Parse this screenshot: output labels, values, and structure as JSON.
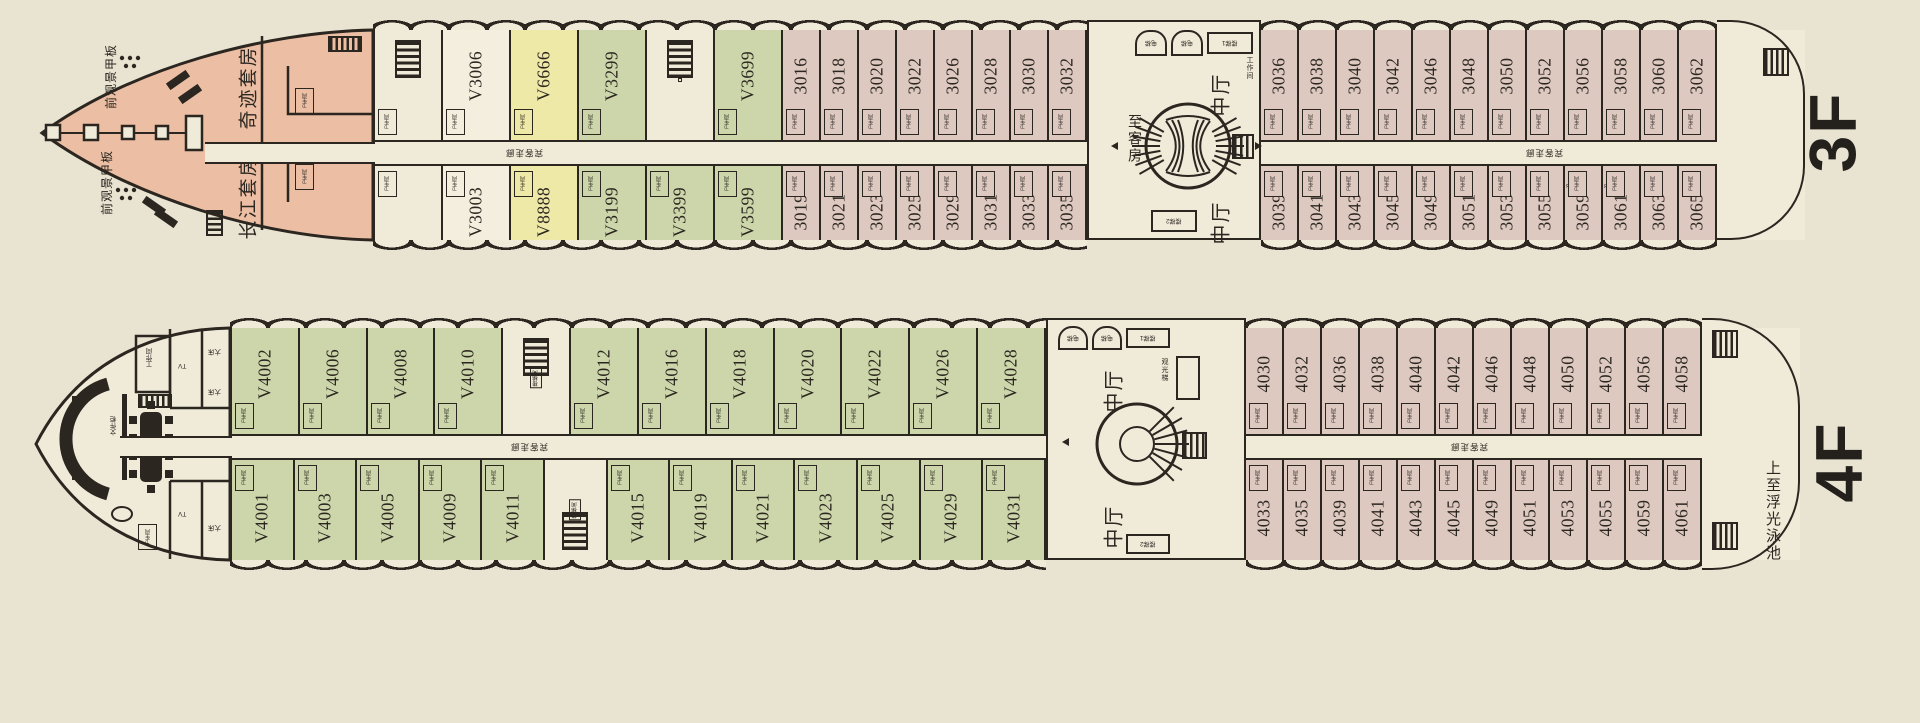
{
  "labels": {
    "wc": "卫生间",
    "corridor": "宾客走廊",
    "lobby": "中厅",
    "to_cabins": "至客房",
    "elevator": "电梯",
    "stair1": "楼梯1",
    "stair2": "楼梯2",
    "stairwell": "楼梯间",
    "workroom": "工作间",
    "sightseeing_lift": "观光梯",
    "pool_note": "上至浮光泳池",
    "fwd_deck": "前观景甲板",
    "miracle_suite": "奇迹套房",
    "yangtze_suite": "长江套房",
    "tv": "TV",
    "big_bed": "大床",
    "file_cabinet": "文件柜",
    "f3": "3F",
    "f4": "4F"
  },
  "colors": {
    "line": "#2b2620",
    "hull": "#f0ebd9",
    "bow": "#ecbfa4",
    "suite_yellow": "#efe9a8",
    "suite_green": "#ccd6aa",
    "cabin_pink": "#ddc9c0"
  },
  "deck3": {
    "floor": "3F",
    "top_suites": [
      {
        "n": "",
        "t": "service"
      },
      {
        "n": "V3006",
        "t": "cream"
      },
      {
        "n": "V6666",
        "t": "yellow"
      },
      {
        "n": "V3299",
        "t": "green"
      },
      {
        "n": "",
        "t": "stairs"
      },
      {
        "n": "V3699",
        "t": "green"
      }
    ],
    "bottom_suites": [
      {
        "n": "",
        "t": "utility"
      },
      {
        "n": "V3003",
        "t": "cream"
      },
      {
        "n": "V8888",
        "t": "yellow"
      },
      {
        "n": "V3199",
        "t": "green"
      },
      {
        "n": "V3399",
        "t": "green"
      },
      {
        "n": "V3599",
        "t": "green"
      }
    ],
    "top_left": [
      {
        "n": "3016",
        "t": "pink"
      },
      {
        "n": "3018",
        "t": "pink"
      },
      {
        "n": "3020",
        "t": "pink"
      },
      {
        "n": "3022",
        "t": "pink"
      },
      {
        "n": "3026",
        "t": "pink"
      },
      {
        "n": "3028",
        "t": "pink"
      },
      {
        "n": "3030",
        "t": "pink"
      },
      {
        "n": "3032",
        "t": "pink"
      }
    ],
    "top_right": [
      {
        "n": "3036",
        "t": "pink"
      },
      {
        "n": "3038",
        "t": "pink"
      },
      {
        "n": "3040",
        "t": "pink"
      },
      {
        "n": "3042",
        "t": "pink"
      },
      {
        "n": "3046",
        "t": "pink"
      },
      {
        "n": "3048",
        "t": "pink"
      },
      {
        "n": "3050",
        "t": "pink"
      },
      {
        "n": "3052",
        "t": "pink"
      },
      {
        "n": "3056",
        "t": "pink"
      },
      {
        "n": "3058",
        "t": "pink"
      },
      {
        "n": "3060",
        "t": "pink"
      },
      {
        "n": "3062",
        "t": "pink"
      }
    ],
    "bottom_left": [
      {
        "n": "3019",
        "t": "pink"
      },
      {
        "n": "3021",
        "t": "pink"
      },
      {
        "n": "3023",
        "t": "pink"
      },
      {
        "n": "3025",
        "t": "pink"
      },
      {
        "n": "3029",
        "t": "pink"
      },
      {
        "n": "3031",
        "t": "pink"
      },
      {
        "n": "3033",
        "t": "pink"
      },
      {
        "n": "3035",
        "t": "pink"
      }
    ],
    "bottom_right": [
      {
        "n": "3039",
        "t": "pink"
      },
      {
        "n": "3041",
        "t": "pink"
      },
      {
        "n": "3043",
        "t": "pink"
      },
      {
        "n": "3045",
        "t": "pink"
      },
      {
        "n": "3049",
        "t": "pink"
      },
      {
        "n": "3051",
        "t": "pink"
      },
      {
        "n": "3053",
        "t": "pink"
      },
      {
        "n": "3055",
        "t": "pink"
      },
      {
        "n": "3059",
        "t": "pink",
        "s": "346"
      },
      {
        "n": "3061",
        "t": "pink",
        "s": "348"
      },
      {
        "n": "3063",
        "t": "pink"
      },
      {
        "n": "3065",
        "t": "pink"
      }
    ]
  },
  "deck4": {
    "floor": "4F",
    "top_suites": [
      {
        "n": "V4002",
        "t": "green"
      },
      {
        "n": "V4006",
        "t": "green"
      },
      {
        "n": "V4008",
        "t": "green"
      },
      {
        "n": "V4010",
        "t": "green"
      },
      {
        "n": "",
        "t": "stairs",
        "s": "楼梯间"
      },
      {
        "n": "V4012",
        "t": "green"
      },
      {
        "n": "V4016",
        "t": "green"
      },
      {
        "n": "V4018",
        "t": "green"
      },
      {
        "n": "V4020",
        "t": "green"
      },
      {
        "n": "V4022",
        "t": "green"
      },
      {
        "n": "V4026",
        "t": "green"
      },
      {
        "n": "V4028",
        "t": "green"
      }
    ],
    "bottom_suites": [
      {
        "n": "V4001",
        "t": "green"
      },
      {
        "n": "V4003",
        "t": "green"
      },
      {
        "n": "V4005",
        "t": "green"
      },
      {
        "n": "V4009",
        "t": "green"
      },
      {
        "n": "V4011",
        "t": "green"
      },
      {
        "n": "",
        "t": "stairs",
        "s": "楼梯间"
      },
      {
        "n": "V4015",
        "t": "green"
      },
      {
        "n": "V4019",
        "t": "green"
      },
      {
        "n": "V4021",
        "t": "green"
      },
      {
        "n": "V4023",
        "t": "green"
      },
      {
        "n": "V4025",
        "t": "green"
      },
      {
        "n": "V4029",
        "t": "green"
      },
      {
        "n": "V4031",
        "t": "green"
      }
    ],
    "top_right": [
      {
        "n": "4030",
        "t": "pink"
      },
      {
        "n": "4032",
        "t": "pink"
      },
      {
        "n": "4036",
        "t": "pink"
      },
      {
        "n": "4038",
        "t": "pink"
      },
      {
        "n": "4040",
        "t": "pink"
      },
      {
        "n": "4042",
        "t": "pink"
      },
      {
        "n": "4046",
        "t": "pink"
      },
      {
        "n": "4048",
        "t": "pink"
      },
      {
        "n": "4050",
        "t": "pink"
      },
      {
        "n": "4052",
        "t": "pink"
      },
      {
        "n": "4056",
        "t": "pink"
      },
      {
        "n": "4058",
        "t": "pink"
      }
    ],
    "bottom_right": [
      {
        "n": "4033",
        "t": "pink"
      },
      {
        "n": "4035",
        "t": "pink"
      },
      {
        "n": "4039",
        "t": "pink"
      },
      {
        "n": "4041",
        "t": "pink"
      },
      {
        "n": "4043",
        "t": "pink"
      },
      {
        "n": "4045",
        "t": "pink"
      },
      {
        "n": "4049",
        "t": "pink"
      },
      {
        "n": "4051",
        "t": "pink"
      },
      {
        "n": "4053",
        "t": "pink"
      },
      {
        "n": "4055",
        "t": "pink"
      },
      {
        "n": "4059",
        "t": "pink"
      },
      {
        "n": "4061",
        "t": "pink"
      }
    ]
  }
}
